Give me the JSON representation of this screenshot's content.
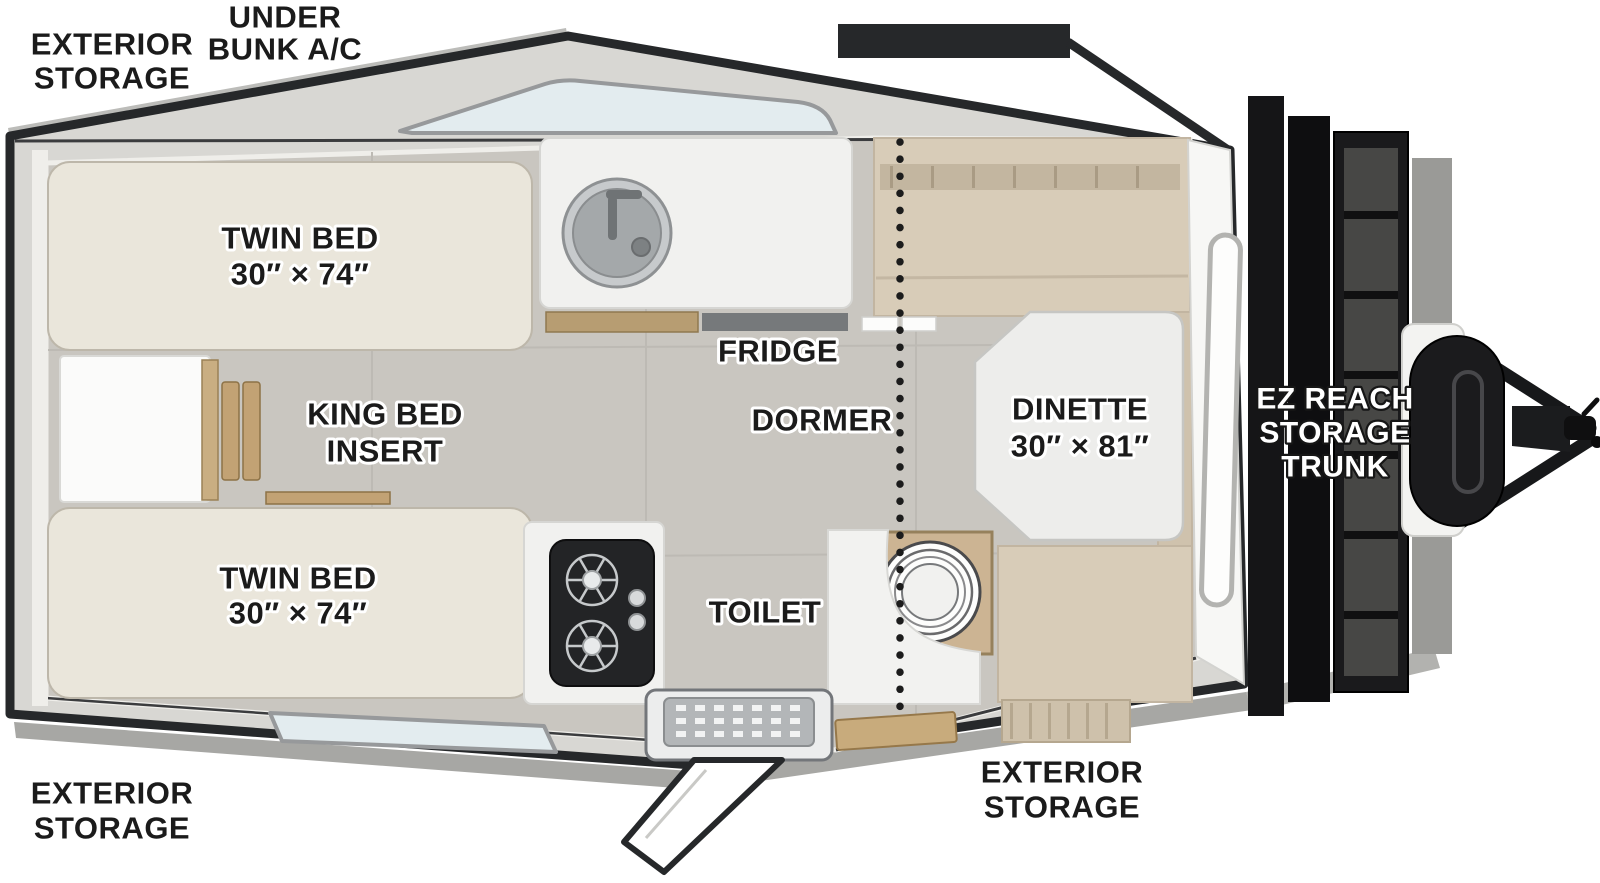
{
  "title": "A-frame camper trailer floorplan (top view)",
  "colors": {
    "outline": "#26282a",
    "wall": "#d8d7d3",
    "floor": "#c9c6c0",
    "bed": "#eae6db",
    "bench": "#d8ccb8",
    "bench_dark": "#cfc2ad",
    "table": "#ededeb",
    "cabinet": "#f1f1ef",
    "window": "#e3ecef",
    "wood": "#c2a274",
    "trunk": "#151517",
    "metal": "#b3b6b8"
  },
  "labels": {
    "exterior_storage_top": [
      "EXTERIOR",
      "STORAGE"
    ],
    "under_bunk_ac": [
      "UNDER",
      "BUNK A/C"
    ],
    "twin_bed_top": [
      "TWIN BED",
      "30″ × 74″"
    ],
    "king_bed_insert": [
      "KING BED",
      "INSERT"
    ],
    "twin_bed_bottom": [
      "TWIN BED",
      "30″ × 74″"
    ],
    "fridge": "FRIDGE",
    "dormer": "DORMER",
    "dinette": [
      "DINETTE",
      "30″ × 81″"
    ],
    "toilet": "TOILET",
    "exterior_storage_bottom_left": [
      "EXTERIOR",
      "STORAGE"
    ],
    "exterior_storage_door_side": [
      "EXTERIOR",
      "STORAGE"
    ],
    "ez_reach_trunk": [
      "EZ REACH",
      "STORAGE",
      "TRUNK"
    ]
  }
}
